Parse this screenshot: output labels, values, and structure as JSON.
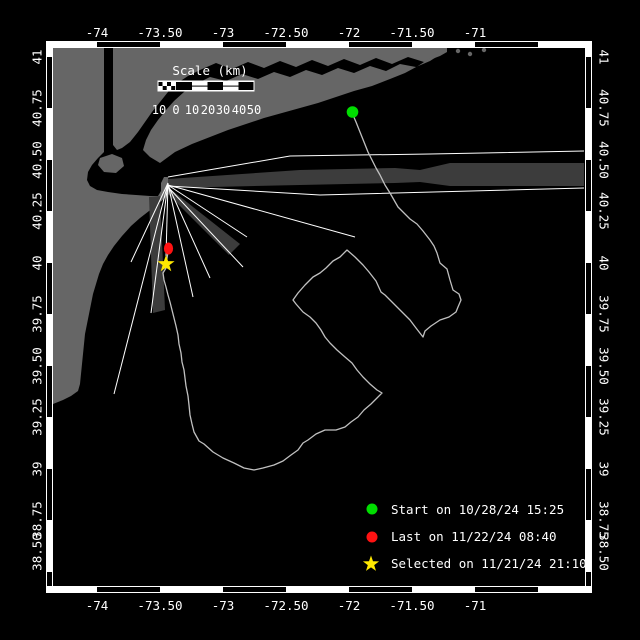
{
  "colors": {
    "ocean": "#000000",
    "land": "#666666",
    "beam": "#3c3c3c",
    "ray": "#ffffff",
    "track": "#c0c0c0",
    "start": "#00dd00",
    "last": "#ff1212",
    "selected": "#ffe800",
    "text": "#ffffff"
  },
  "axes": {
    "lon": {
      "labels": [
        "-74",
        "-73.50",
        "-73",
        "-72.50",
        "-72",
        "-71.50",
        "-71"
      ]
    },
    "lat": {
      "labels": [
        "41",
        "40.75",
        "40.50",
        "40.25",
        "40",
        "39.75",
        "39.50",
        "39.25",
        "39",
        "38.75",
        "38.50"
      ]
    }
  },
  "scalebar": {
    "title": "Scale (km)",
    "tick_labels": [
      "10",
      "0",
      "10",
      "20",
      "30",
      "40",
      "50"
    ]
  },
  "legend": {
    "items": [
      {
        "marker": "start-dot",
        "label": "Start on 10/28/24 15:25"
      },
      {
        "marker": "last-dot",
        "label": "Last on 11/22/24 08:40"
      },
      {
        "marker": "selected-star",
        "label": "Selected on 11/21/24 21:10"
      }
    ],
    "star_points": [
      [
        371,
        555.5
      ],
      [
        373,
        561.3
      ],
      [
        379.1,
        561.4
      ],
      [
        374.2,
        565.1
      ],
      [
        376,
        570.9
      ],
      [
        371,
        567.4
      ],
      [
        366,
        570.9
      ],
      [
        367.8,
        565.1
      ],
      [
        362.9,
        561.4
      ],
      [
        369,
        561.3
      ]
    ]
  },
  "markers": {
    "start": {
      "x": 352.5,
      "y": 112
    },
    "last": {
      "x": 168.5,
      "y": 248.5
    },
    "selected_points": [
      [
        166,
        255
      ],
      [
        168.1,
        261.1
      ],
      [
        174.6,
        261.2
      ],
      [
        169.4,
        265.1
      ],
      [
        171.3,
        271.3
      ],
      [
        166,
        267.6
      ],
      [
        160.7,
        271.3
      ],
      [
        162.6,
        265.1
      ],
      [
        157.4,
        261.2
      ],
      [
        163.9,
        261.1
      ]
    ]
  },
  "frame": {
    "h_bounds": [
      53,
      97,
      160,
      223,
      286,
      349,
      412,
      475,
      538,
      584
    ],
    "v_bounds": [
      48,
      57,
      108,
      160,
      211,
      263,
      314,
      366,
      417,
      469,
      520,
      572,
      586
    ],
    "top_y": 41,
    "bottom_y": 586,
    "left_x": 46,
    "right_x": 585,
    "band": 7
  },
  "geometry": {
    "land": {
      "new_jersey": [
        [
          53,
          48
        ],
        [
          104,
          48
        ],
        [
          104,
          152
        ],
        [
          98,
          158
        ],
        [
          92,
          165
        ],
        [
          88,
          172
        ],
        [
          87,
          180
        ],
        [
          90,
          186
        ],
        [
          97,
          190
        ],
        [
          108,
          192
        ],
        [
          122,
          194
        ],
        [
          136,
          195
        ],
        [
          150,
          196
        ],
        [
          158,
          196
        ],
        [
          161,
          191
        ],
        [
          161,
          183
        ],
        [
          164,
          177
        ],
        [
          168,
          177
        ],
        [
          169,
          185
        ],
        [
          168,
          193
        ],
        [
          165,
          198
        ],
        [
          158,
          204
        ],
        [
          149,
          211
        ],
        [
          140,
          218
        ],
        [
          131,
          226
        ],
        [
          122,
          236
        ],
        [
          114,
          246
        ],
        [
          108,
          255
        ],
        [
          103,
          264
        ],
        [
          99,
          274
        ],
        [
          96,
          284
        ],
        [
          93,
          294
        ],
        [
          91,
          304
        ],
        [
          89,
          314
        ],
        [
          87,
          324
        ],
        [
          85,
          334
        ],
        [
          84,
          344
        ],
        [
          83,
          354
        ],
        [
          82,
          364
        ],
        [
          81,
          374
        ],
        [
          80,
          384
        ],
        [
          78,
          391
        ],
        [
          71,
          396
        ],
        [
          63,
          400
        ],
        [
          53,
          404
        ]
      ],
      "mainland_north": [
        [
          113,
          48
        ],
        [
          447,
          48
        ],
        [
          447,
          52
        ],
        [
          440,
          56
        ],
        [
          424,
          62
        ],
        [
          408,
          57
        ],
        [
          392,
          64
        ],
        [
          376,
          58
        ],
        [
          360,
          65
        ],
        [
          344,
          59
        ],
        [
          328,
          66
        ],
        [
          312,
          60
        ],
        [
          296,
          67
        ],
        [
          280,
          61
        ],
        [
          264,
          68
        ],
        [
          248,
          62
        ],
        [
          232,
          69
        ],
        [
          216,
          63
        ],
        [
          200,
          70
        ],
        [
          188,
          76
        ],
        [
          176,
          84
        ],
        [
          168,
          92
        ],
        [
          160,
          102
        ],
        [
          152,
          112
        ],
        [
          145,
          122
        ],
        [
          138,
          132
        ],
        [
          130,
          142
        ],
        [
          122,
          148
        ],
        [
          117,
          150
        ],
        [
          113,
          145
        ]
      ],
      "long_island": [
        [
          160,
          163
        ],
        [
          150,
          157
        ],
        [
          143,
          150
        ],
        [
          146,
          140
        ],
        [
          151,
          130
        ],
        [
          158,
          120
        ],
        [
          166,
          110
        ],
        [
          174,
          101
        ],
        [
          184,
          92
        ],
        [
          196,
          84
        ],
        [
          210,
          77
        ],
        [
          226,
          81
        ],
        [
          242,
          74
        ],
        [
          258,
          79
        ],
        [
          274,
          72
        ],
        [
          290,
          77
        ],
        [
          306,
          70
        ],
        [
          322,
          75
        ],
        [
          338,
          68
        ],
        [
          354,
          73
        ],
        [
          370,
          66
        ],
        [
          386,
          71
        ],
        [
          400,
          64
        ],
        [
          416,
          67
        ],
        [
          430,
          61
        ],
        [
          441,
          54
        ],
        [
          447,
          48
        ],
        [
          440,
          51
        ],
        [
          430,
          58
        ],
        [
          418,
          66
        ],
        [
          405,
          73
        ],
        [
          390,
          79
        ],
        [
          372,
          86
        ],
        [
          354,
          91
        ],
        [
          336,
          97
        ],
        [
          318,
          103
        ],
        [
          300,
          108
        ],
        [
          282,
          113
        ],
        [
          264,
          118
        ],
        [
          246,
          124
        ],
        [
          228,
          130
        ],
        [
          210,
          137
        ],
        [
          192,
          144
        ],
        [
          175,
          152
        ]
      ],
      "staten_island": [
        [
          100,
          158
        ],
        [
          112,
          154
        ],
        [
          122,
          158
        ],
        [
          124,
          166
        ],
        [
          116,
          173
        ],
        [
          104,
          172
        ],
        [
          98,
          165
        ]
      ],
      "islands": [
        [
          458,
          51
        ],
        [
          470,
          54
        ],
        [
          484,
          50
        ]
      ]
    },
    "beams": {
      "east": [
        [
          168,
          179
        ],
        [
          300,
          170
        ],
        [
          395,
          168
        ],
        [
          420,
          170
        ],
        [
          450,
          163
        ],
        [
          584,
          163
        ],
        [
          584,
          186
        ],
        [
          450,
          186
        ],
        [
          420,
          182
        ],
        [
          395,
          183
        ],
        [
          300,
          185
        ],
        [
          168,
          188
        ]
      ],
      "southeast": [
        [
          169,
          188
        ],
        [
          240,
          244
        ],
        [
          229,
          255
        ],
        [
          166,
          192
        ]
      ],
      "south": [
        [
          149,
          197
        ],
        [
          160,
          196
        ],
        [
          165,
          310
        ],
        [
          153,
          313
        ]
      ]
    },
    "rays": {
      "r0": [
        [
          168,
          177
        ],
        [
          290,
          156
        ],
        [
          430,
          154
        ],
        [
          584,
          151
        ]
      ],
      "r1": [
        [
          168,
          186
        ],
        [
          320,
          195
        ],
        [
          584,
          188
        ]
      ],
      "r2": [
        [
          168,
          185
        ],
        [
          355,
          237
        ]
      ],
      "r3": [
        [
          168,
          185
        ],
        [
          247,
          237
        ]
      ],
      "r4": [
        [
          168,
          187
        ],
        [
          243,
          267
        ]
      ],
      "r5": [
        [
          168,
          185
        ],
        [
          210,
          278
        ]
      ],
      "r6": [
        [
          168,
          184
        ],
        [
          193,
          297
        ]
      ],
      "r7": [
        [
          168,
          183
        ],
        [
          166,
          256
        ]
      ],
      "r8": [
        [
          168,
          183
        ],
        [
          151,
          313
        ]
      ],
      "r9": [
        [
          168,
          183
        ],
        [
          131,
          262
        ]
      ],
      "r10": [
        [
          168,
          183
        ],
        [
          114,
          394
        ]
      ]
    },
    "track": [
      [
        353,
        115
      ],
      [
        356,
        122
      ],
      [
        360,
        132
      ],
      [
        364,
        142
      ],
      [
        368,
        152
      ],
      [
        372,
        160
      ],
      [
        376,
        168
      ],
      [
        380,
        175
      ],
      [
        385,
        185
      ],
      [
        390,
        193
      ],
      [
        394,
        200
      ],
      [
        398,
        207
      ],
      [
        404,
        213
      ],
      [
        410,
        219
      ],
      [
        417,
        224
      ],
      [
        423,
        231
      ],
      [
        430,
        240
      ],
      [
        434,
        246
      ],
      [
        437,
        253
      ],
      [
        440,
        263
      ],
      [
        447,
        269
      ],
      [
        450,
        280
      ],
      [
        453,
        290
      ],
      [
        459,
        294
      ],
      [
        461,
        300
      ],
      [
        458,
        307
      ],
      [
        456,
        312
      ],
      [
        449,
        317
      ],
      [
        440,
        320
      ],
      [
        431,
        326
      ],
      [
        425,
        331
      ],
      [
        423,
        337
      ],
      [
        416,
        328
      ],
      [
        410,
        320
      ],
      [
        401,
        311
      ],
      [
        392,
        302
      ],
      [
        385,
        295
      ],
      [
        381,
        292
      ],
      [
        376,
        281
      ],
      [
        369,
        272
      ],
      [
        363,
        265
      ],
      [
        355,
        257
      ],
      [
        347,
        250
      ],
      [
        340,
        257
      ],
      [
        333,
        261
      ],
      [
        326,
        268
      ],
      [
        320,
        273
      ],
      [
        313,
        277
      ],
      [
        305,
        285
      ],
      [
        298,
        293
      ],
      [
        293,
        300
      ],
      [
        296,
        304
      ],
      [
        303,
        312
      ],
      [
        310,
        317
      ],
      [
        316,
        323
      ],
      [
        321,
        330
      ],
      [
        325,
        337
      ],
      [
        330,
        343
      ],
      [
        337,
        350
      ],
      [
        345,
        357
      ],
      [
        352,
        363
      ],
      [
        357,
        370
      ],
      [
        363,
        377
      ],
      [
        370,
        384
      ],
      [
        377,
        390
      ],
      [
        382,
        393
      ],
      [
        377,
        398
      ],
      [
        371,
        404
      ],
      [
        364,
        410
      ],
      [
        358,
        417
      ],
      [
        351,
        422
      ],
      [
        345,
        427
      ],
      [
        336,
        430
      ],
      [
        325,
        430
      ],
      [
        316,
        434
      ],
      [
        308,
        440
      ],
      [
        303,
        443
      ],
      [
        298,
        450
      ],
      [
        291,
        455
      ],
      [
        283,
        461
      ],
      [
        274,
        465
      ],
      [
        263,
        468
      ],
      [
        254,
        470
      ],
      [
        244,
        468
      ],
      [
        234,
        463
      ],
      [
        223,
        458
      ],
      [
        213,
        452
      ],
      [
        204,
        444
      ],
      [
        199,
        441
      ],
      [
        194,
        432
      ],
      [
        192,
        424
      ],
      [
        190,
        415
      ],
      [
        189,
        405
      ],
      [
        188,
        396
      ],
      [
        186,
        386
      ],
      [
        185,
        378
      ],
      [
        184,
        370
      ],
      [
        182,
        362
      ],
      [
        181,
        353
      ],
      [
        179,
        344
      ],
      [
        178,
        335
      ],
      [
        176,
        326
      ],
      [
        174,
        318
      ],
      [
        172,
        310
      ],
      [
        170,
        302
      ],
      [
        168,
        295
      ],
      [
        166,
        287
      ],
      [
        164,
        280
      ],
      [
        163,
        273
      ],
      [
        166,
        268
      ],
      [
        166,
        264
      ],
      [
        167,
        258
      ],
      [
        168,
        252
      ]
    ]
  }
}
